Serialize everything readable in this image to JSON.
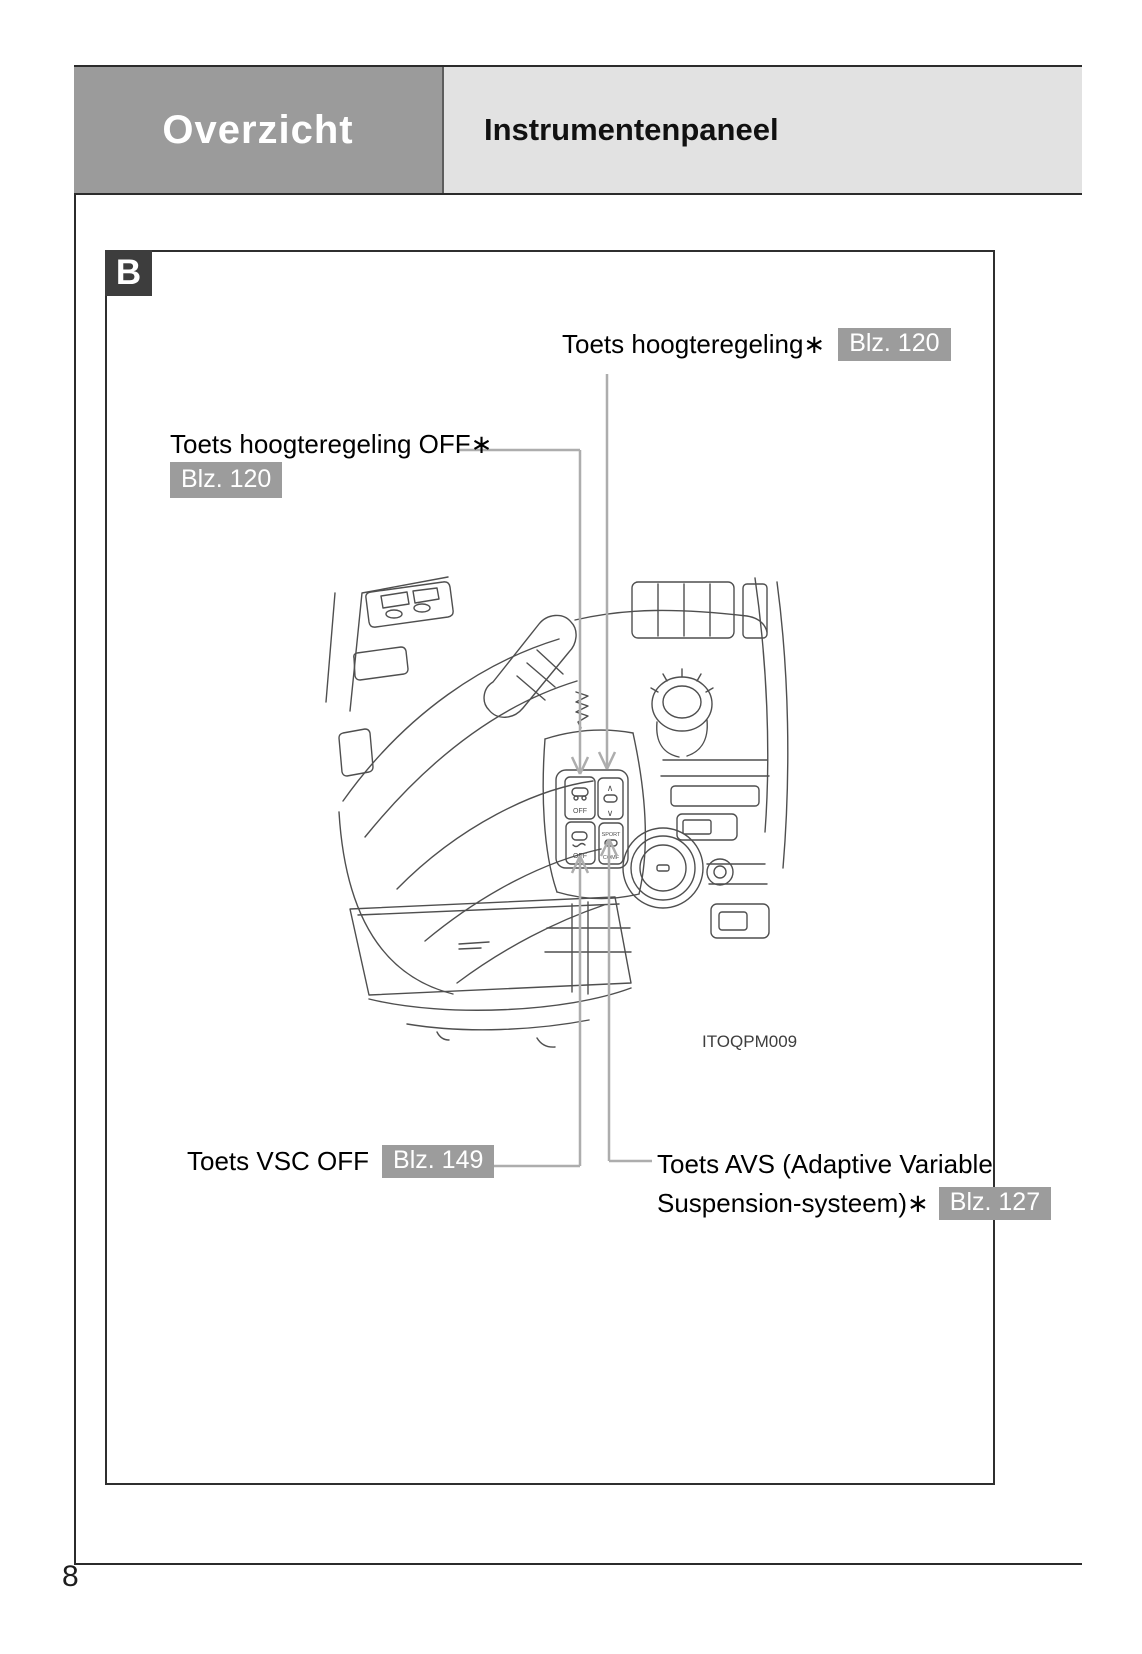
{
  "header": {
    "section_label": "Overzicht",
    "page_title": "Instrumentenpaneel"
  },
  "figure": {
    "panel_letter": "B",
    "image_code": "ITOQPM009",
    "callout_height": {
      "label": "Toets hoogteregeling∗",
      "ref": "Blz. 120"
    },
    "callout_height_off": {
      "label": "Toets hoogteregeling OFF∗",
      "ref": "Blz. 120"
    },
    "callout_vsc": {
      "label": "Toets VSC OFF",
      "ref": "Blz. 149"
    },
    "callout_avs": {
      "label_line1": "Toets AVS (Adaptive Variable",
      "label_line2": "Suspension-systeem)∗",
      "ref": "Blz. 127"
    },
    "sketch_buttons": {
      "height_off": "OFF",
      "height_up": "∧",
      "height_down": "∨",
      "vsc_off": "OFF",
      "avs_sport": "SPORT",
      "avs_comf": "COMF"
    }
  },
  "footer": {
    "page_number": "8"
  },
  "colors": {
    "header_left_bg": "#9b9b9b",
    "header_right_bg": "#e2e2e2",
    "badge_bg": "#9c9c9c",
    "panel_letter_bg": "#3d3d3d",
    "rule": "#2b2b2b",
    "leader_line": "#adadad",
    "sketch_stroke": "#4f4f4f"
  }
}
